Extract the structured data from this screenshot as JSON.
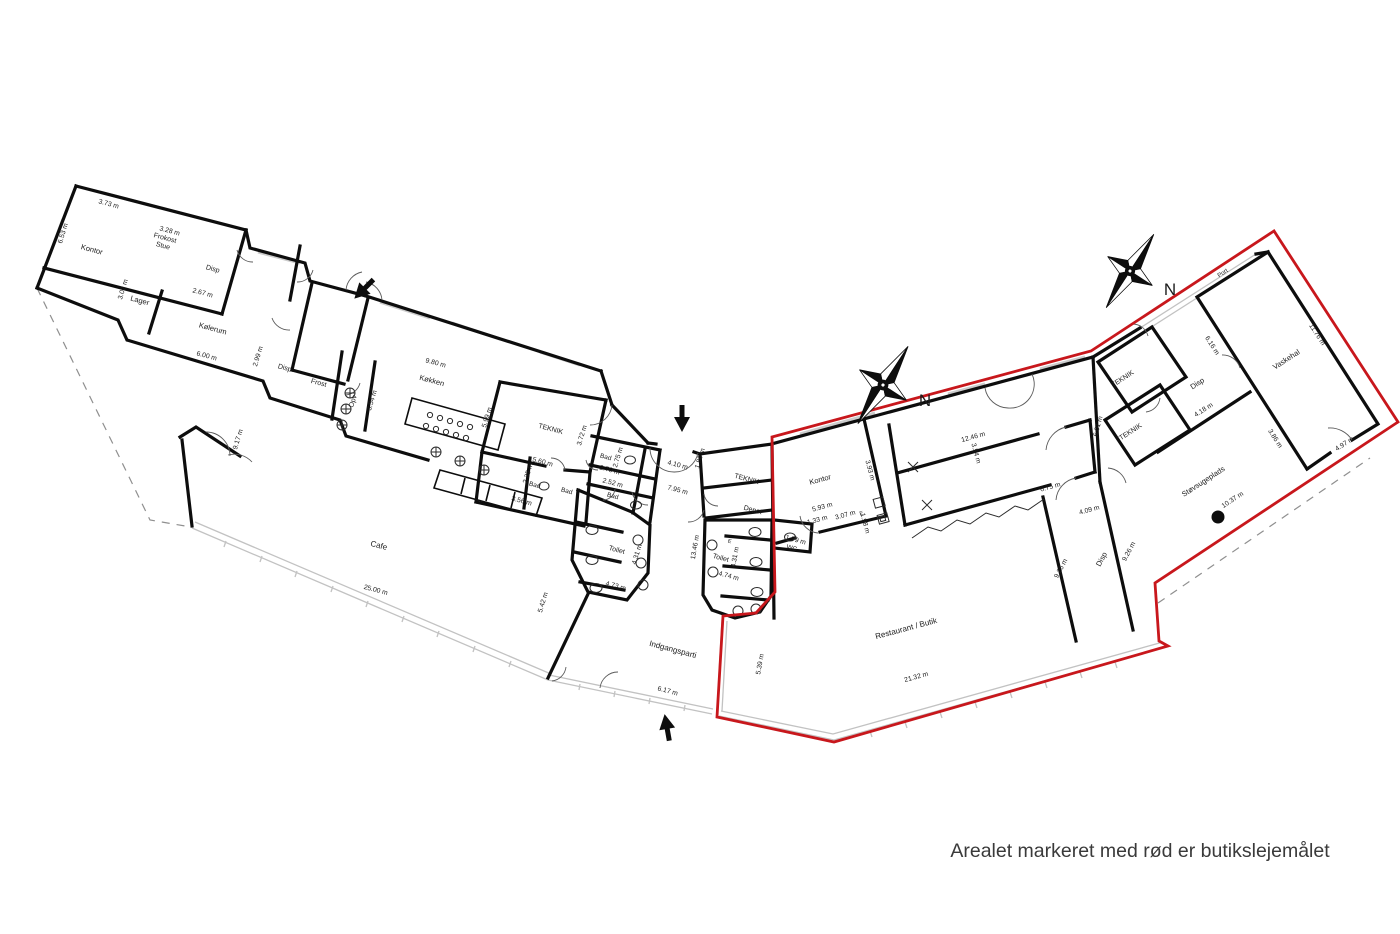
{
  "caption": "Arealet markeret med rød er butikslejemålet",
  "colors": {
    "lease_outline": "#c8171c",
    "walls": "#0d0d0d",
    "glass": "#c2c2c2",
    "text": "#1b1b1b"
  },
  "compass": [
    {
      "label": "N",
      "x": 925,
      "y": 403
    },
    {
      "label": "N",
      "x": 1170,
      "y": 292
    }
  ],
  "rooms": [
    {
      "label": "Kontor",
      "x": 92,
      "y": 249,
      "r": 15,
      "s": 7.5
    },
    {
      "label": "Frokost\nStue",
      "x": 164,
      "y": 242,
      "r": 15,
      "s": 7
    },
    {
      "label": "Disp",
      "x": 213,
      "y": 268,
      "r": 15,
      "s": 7
    },
    {
      "label": "Lager",
      "x": 140,
      "y": 300,
      "r": 15,
      "s": 7.5
    },
    {
      "label": "Kølerum",
      "x": 213,
      "y": 328,
      "r": 15,
      "s": 7.5
    },
    {
      "label": "Disp",
      "x": 285,
      "y": 367,
      "r": 15,
      "s": 7
    },
    {
      "label": "Frost",
      "x": 319,
      "y": 382,
      "r": 15,
      "s": 7
    },
    {
      "label": "Opv",
      "x": 352,
      "y": 401,
      "r": -73,
      "s": 7
    },
    {
      "label": "Køkken",
      "x": 432,
      "y": 380,
      "r": 15,
      "s": 7.5
    },
    {
      "label": "TEKNIK",
      "x": 551,
      "y": 428,
      "r": 15,
      "s": 7
    },
    {
      "label": "Bad",
      "x": 535,
      "y": 484,
      "r": 15,
      "s": 6.5
    },
    {
      "label": "Bad",
      "x": 567,
      "y": 490,
      "r": 15,
      "s": 6.5
    },
    {
      "label": "Bad",
      "x": 606,
      "y": 456,
      "r": 15,
      "s": 6.5
    },
    {
      "label": "Bad",
      "x": 613,
      "y": 495,
      "r": 15,
      "s": 6.5
    },
    {
      "label": "Toilet",
      "x": 617,
      "y": 549,
      "r": 15,
      "s": 7
    },
    {
      "label": "Toilet",
      "x": 721,
      "y": 557,
      "r": 15,
      "s": 7
    },
    {
      "label": "WC",
      "x": 792,
      "y": 547,
      "r": 15,
      "s": 6.5
    },
    {
      "label": "Depot",
      "x": 753,
      "y": 509,
      "r": 15,
      "s": 7
    },
    {
      "label": "TEKNIK",
      "x": 747,
      "y": 478,
      "r": 15,
      "s": 7
    },
    {
      "label": "Kontor",
      "x": 820,
      "y": 479,
      "r": -15,
      "s": 7.5
    },
    {
      "label": "Cafe",
      "x": 379,
      "y": 545,
      "r": 15,
      "s": 8
    },
    {
      "label": "Indgangsparti",
      "x": 673,
      "y": 649,
      "r": 15,
      "s": 8
    },
    {
      "label": "Restaurant / Butik",
      "x": 906,
      "y": 628,
      "r": -15,
      "s": 8
    },
    {
      "label": "Disp",
      "x": 1101,
      "y": 559,
      "r": -62,
      "s": 7.5
    },
    {
      "label": "TEKNIK",
      "x": 1130,
      "y": 431,
      "r": -33,
      "s": 7
    },
    {
      "label": "TEKNIK",
      "x": 1122,
      "y": 378,
      "r": -33,
      "s": 7
    },
    {
      "label": "Disp",
      "x": 1197,
      "y": 383,
      "r": -33,
      "s": 7.5
    },
    {
      "label": "Vaskehal",
      "x": 1286,
      "y": 359,
      "r": -33,
      "s": 7.5
    },
    {
      "label": "Støvsugeplads",
      "x": 1203,
      "y": 481,
      "r": -33,
      "s": 7.5
    },
    {
      "label": "Port",
      "x": 1222,
      "y": 272,
      "r": -33,
      "s": 6
    },
    {
      "label": "E",
      "x": 861,
      "y": 512,
      "r": -15,
      "s": 5.5
    },
    {
      "label": "E",
      "x": 730,
      "y": 540,
      "r": 15,
      "s": 5.5
    }
  ],
  "measurements": [
    {
      "label": "3.73 m",
      "x": 109,
      "y": 203,
      "r": 15
    },
    {
      "label": "6.53 m",
      "x": 62,
      "y": 233,
      "r": -73
    },
    {
      "label": "3.28 m",
      "x": 170,
      "y": 230,
      "r": 15
    },
    {
      "label": "3.02 m",
      "x": 122,
      "y": 289,
      "r": -73
    },
    {
      "label": "2.67 m",
      "x": 203,
      "y": 292,
      "r": 15
    },
    {
      "label": "6.00 m",
      "x": 207,
      "y": 355,
      "r": 15
    },
    {
      "label": "2.99 m",
      "x": 257,
      "y": 356,
      "r": -73
    },
    {
      "label": "9.80 m",
      "x": 436,
      "y": 362,
      "r": 15
    },
    {
      "label": "3.54 m",
      "x": 371,
      "y": 400,
      "r": -73
    },
    {
      "label": "5.99 m",
      "x": 486,
      "y": 417,
      "r": -73
    },
    {
      "label": "3.72 m",
      "x": 581,
      "y": 435,
      "r": -73
    },
    {
      "label": "5.60 m",
      "x": 543,
      "y": 461,
      "r": 15
    },
    {
      "label": "2.35 m",
      "x": 527,
      "y": 473,
      "r": -73
    },
    {
      "label": "3.56 m",
      "x": 522,
      "y": 500,
      "r": 15
    },
    {
      "label": "2.75 m",
      "x": 617,
      "y": 457,
      "r": -73
    },
    {
      "label": "2.70 m",
      "x": 610,
      "y": 469,
      "r": 15
    },
    {
      "label": "2.52 m",
      "x": 613,
      "y": 482,
      "r": 15
    },
    {
      "label": "4.10 m",
      "x": 678,
      "y": 464,
      "r": 15
    },
    {
      "label": "1.80 m",
      "x": 699,
      "y": 458,
      "r": -73
    },
    {
      "label": "7.95 m",
      "x": 678,
      "y": 489,
      "r": 15
    },
    {
      "label": "4.31 m",
      "x": 636,
      "y": 554,
      "r": -73
    },
    {
      "label": "4.73 m",
      "x": 616,
      "y": 585,
      "r": 15
    },
    {
      "label": "13.46 m",
      "x": 694,
      "y": 547,
      "r": -80
    },
    {
      "label": "4.31 m",
      "x": 734,
      "y": 557,
      "r": -80
    },
    {
      "label": "4.74 m",
      "x": 729,
      "y": 575,
      "r": 15
    },
    {
      "label": "1.79 m",
      "x": 796,
      "y": 539,
      "r": 15
    },
    {
      "label": "5.93 m",
      "x": 822,
      "y": 506,
      "r": -15
    },
    {
      "label": "1.33 m",
      "x": 817,
      "y": 519,
      "r": -15
    },
    {
      "label": "3.07 m",
      "x": 845,
      "y": 514,
      "r": -15
    },
    {
      "label": "1.98 m",
      "x": 866,
      "y": 523,
      "r": 75
    },
    {
      "label": "3.93 m",
      "x": 871,
      "y": 470,
      "r": 75
    },
    {
      "label": "12.46 m",
      "x": 973,
      "y": 436,
      "r": -15
    },
    {
      "label": "3.54 m",
      "x": 977,
      "y": 453,
      "r": 75
    },
    {
      "label": "6.75 m",
      "x": 1050,
      "y": 486,
      "r": -15
    },
    {
      "label": "4.09 m",
      "x": 1089,
      "y": 509,
      "r": -15
    },
    {
      "label": "9.26 m",
      "x": 1060,
      "y": 568,
      "r": -62
    },
    {
      "label": "9.26 m",
      "x": 1128,
      "y": 551,
      "r": -62
    },
    {
      "label": "6.01 m",
      "x": 1097,
      "y": 426,
      "r": -75
    },
    {
      "label": "4.18 m",
      "x": 1203,
      "y": 409,
      "r": -33
    },
    {
      "label": "6.16 m",
      "x": 1213,
      "y": 345,
      "r": 57
    },
    {
      "label": "3.86 m",
      "x": 1276,
      "y": 438,
      "r": 57
    },
    {
      "label": "11.76 m",
      "x": 1318,
      "y": 334,
      "r": 57
    },
    {
      "label": "4.97 m",
      "x": 1344,
      "y": 443,
      "r": -33
    },
    {
      "label": "10.37 m",
      "x": 1232,
      "y": 499,
      "r": -33
    },
    {
      "label": "9.17 m",
      "x": 237,
      "y": 439,
      "r": -73
    },
    {
      "label": "25.00 m",
      "x": 376,
      "y": 589,
      "r": 15
    },
    {
      "label": "5.42 m",
      "x": 542,
      "y": 602,
      "r": -73
    },
    {
      "label": "6.17 m",
      "x": 668,
      "y": 690,
      "r": 15
    },
    {
      "label": "5.39 m",
      "x": 759,
      "y": 664,
      "r": -80
    },
    {
      "label": "21.32 m",
      "x": 916,
      "y": 676,
      "r": -15
    }
  ]
}
